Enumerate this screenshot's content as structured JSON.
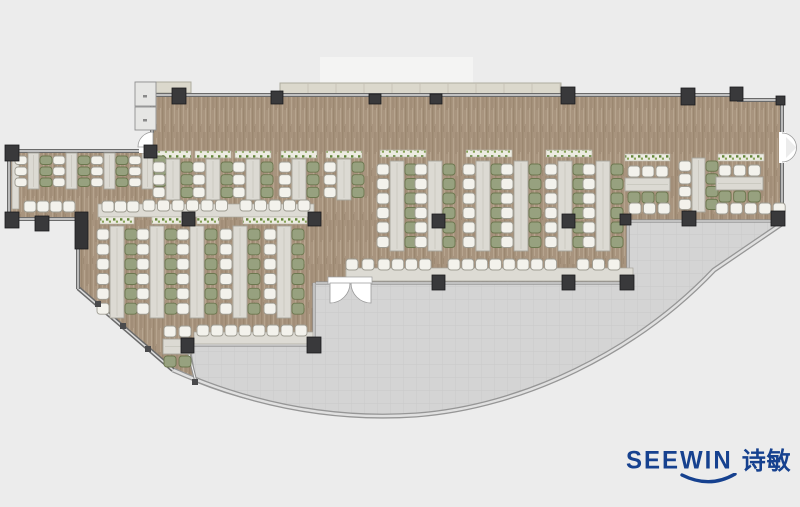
{
  "canvas": {
    "width": 800,
    "height": 507,
    "background": "#ececec"
  },
  "logo": {
    "brand": "SEEWIN",
    "brand_zh": "诗敏",
    "color": "#16418f"
  },
  "palette": {
    "floor_base": "#a8947e",
    "floor_grain_dark": "#9b8770",
    "floor_grain_light": "#b6a48e",
    "floor_grain_deep": "#8e7a64",
    "terrace": "#d4d4d4",
    "terrace_grid": "#c9c9c9",
    "wall_dark": "#6a6a6a",
    "wall_core": "#dcdcdc",
    "glass": "#8f8f8f",
    "glass_core": "#f3f3f3",
    "curve_outer": "#969696",
    "curve_core": "#e0e0e0",
    "column": "#39393b",
    "column_stroke": "#1b1b1d",
    "table": "#dcdad3",
    "table_stroke": "#a6a49b",
    "table_seam": "#c6c4bb",
    "chair_white": "#f3f2ec",
    "chair_white_stroke": "#9e9c92",
    "chair_green": "#97a17f",
    "chair_green_stroke": "#6c774f",
    "planter_bg": "#edece2",
    "planter_dot1": "#628539",
    "planter_dot2": "#85a355",
    "planter_stroke": "#b9b7aa",
    "ledge": "#dbd8cc",
    "ledge_line": "#c3c0b2",
    "ledge_stroke": "#aeab9e",
    "counter": "#dddbd4",
    "door_white": "#ffffff",
    "door_stroke": "#9a9a9a",
    "panel": "#e6e6e4",
    "panel_stroke": "#8f8f8f",
    "light_patch": "#f4f4f3"
  },
  "plan": {
    "floor_path": "M152 95 L737 95 L737 100 L782 100 L782 221 L628 221 L628 283 L316 283 L316 345 L190 345 L196 382 L173 370 L78 288 L78 219 L8 219 L8 151 L152 151 Z",
    "terrace_path": "M190 346 L314 346 L314 283 L628 283 L628 221 L782 221 L782 224 L714 270 C636 352 523 407 416 415 C325 421 245 402 196 382 Z",
    "curve_wall_path": "M173 370 C245 402 325 421 416 415 C523 407 636 352 714 270 L783 223",
    "diag_wall": [
      78,
      288,
      173,
      370
    ],
    "main_walls": [
      [
        150,
        95,
        737,
        95
      ],
      [
        737,
        95,
        737,
        100
      ],
      [
        737,
        100,
        782,
        100
      ],
      [
        782,
        100,
        782,
        133
      ],
      [
        782,
        162,
        782,
        221
      ],
      [
        152,
        95,
        152,
        133
      ],
      [
        8,
        151,
        155,
        151
      ],
      [
        9,
        151,
        9,
        220
      ],
      [
        9,
        219,
        78,
        219
      ],
      [
        78,
        248,
        78,
        289
      ]
    ],
    "glass_walls": [
      [
        190,
        345,
        316,
        345
      ],
      [
        314,
        283,
        314,
        346
      ],
      [
        316,
        283,
        329,
        283
      ],
      [
        371,
        283,
        628,
        283
      ],
      [
        628,
        221,
        628,
        284
      ],
      [
        627,
        221,
        783,
        221
      ],
      [
        187,
        346,
        196,
        382
      ]
    ],
    "ledge": [
      280,
      83,
      281,
      12
    ],
    "canopy": [
      137,
      82,
      54,
      11
    ],
    "light_patch": [
      320,
      57,
      153,
      27
    ],
    "counters": [
      [
        346,
        268,
        287,
        13
      ],
      [
        194,
        332,
        119,
        12
      ],
      [
        98,
        204,
        216,
        13
      ],
      [
        12,
        153,
        7,
        56
      ]
    ],
    "planters": [
      [
        155,
        151,
        36
      ],
      [
        195,
        151,
        36
      ],
      [
        235,
        151,
        36
      ],
      [
        281,
        151,
        36
      ],
      [
        326,
        151,
        36
      ],
      [
        380,
        150,
        46
      ],
      [
        466,
        150,
        46
      ],
      [
        546,
        150,
        46
      ],
      [
        625,
        154,
        45
      ],
      [
        718,
        154,
        46
      ],
      [
        100,
        217,
        34
      ],
      [
        152,
        217,
        30
      ],
      [
        197,
        217,
        22
      ],
      [
        243,
        217,
        64
      ]
    ],
    "desk_units_vertical": [
      {
        "x": [
          28,
          66,
          104,
          142
        ],
        "y1": 153,
        "y2": 189,
        "tw": 11,
        "chairs": 3,
        "left": "w",
        "right": "g"
      },
      {
        "x": [
          166,
          206,
          246,
          292,
          337
        ],
        "y1": 159,
        "y2": 200,
        "tw": 14,
        "chairs": 3,
        "left": "w",
        "right": "g"
      },
      {
        "x": [
          390,
          428,
          476,
          514,
          558,
          596
        ],
        "y1": 161,
        "y2": 251,
        "tw": 14,
        "chairs": 6,
        "left": "w",
        "right": "g"
      },
      {
        "x": [
          110,
          150,
          190,
          233,
          277
        ],
        "y1": 226,
        "y2": 318,
        "tw": 14,
        "chairs": 6,
        "left": "w",
        "right": "g"
      },
      {
        "x": [
          692
        ],
        "y1": 158,
        "y2": 212,
        "tw": 13,
        "chairs": 4,
        "left": "w",
        "right": "g"
      }
    ],
    "desk_units_horizontal": [
      {
        "x1": 625,
        "x2": 670,
        "ty": 178,
        "th": 13,
        "chairs": 3,
        "top": "w",
        "bottom": "g"
      },
      {
        "x1": 716,
        "x2": 763,
        "ty": 177,
        "th": 13,
        "chairs": 3,
        "top": "w",
        "bottom": "g"
      }
    ],
    "chair_rows": [
      {
        "x": 24,
        "y": 201,
        "n": 4,
        "pitch": 13,
        "c": "w"
      },
      {
        "x": 102,
        "y": 201,
        "n": 3,
        "pitch": 12.5,
        "c": "w"
      },
      {
        "x": 143,
        "y": 200,
        "n": 6,
        "pitch": 14.5,
        "c": "w"
      },
      {
        "x": 240,
        "y": 200,
        "n": 5,
        "pitch": 14.5,
        "c": "w"
      },
      {
        "x": 346,
        "y": 259,
        "n": 2,
        "pitch": 16,
        "c": "w"
      },
      {
        "x": 378,
        "y": 259,
        "n": 4,
        "pitch": 13.7,
        "c": "w"
      },
      {
        "x": 448,
        "y": 259,
        "n": 8,
        "pitch": 13.8,
        "c": "w"
      },
      {
        "x": 577,
        "y": 259,
        "n": 3,
        "pitch": 15.5,
        "c": "w"
      },
      {
        "x": 197,
        "y": 325,
        "n": 8,
        "pitch": 14,
        "c": "w"
      },
      {
        "x": 629,
        "y": 203,
        "n": 3,
        "pitch": 14.5,
        "c": "w"
      },
      {
        "x": 716,
        "y": 203,
        "n": 5,
        "pitch": 14.3,
        "c": "w"
      }
    ],
    "small_table": {
      "table": [
        163,
        339,
        29,
        15
      ],
      "chairs": [
        [
          164,
          326,
          "w"
        ],
        [
          179,
          326,
          "w"
        ],
        [
          164,
          356,
          "g"
        ],
        [
          179,
          356,
          "g"
        ]
      ]
    },
    "columns": [
      [
        172,
        88,
        14,
        16
      ],
      [
        271,
        91,
        12,
        13
      ],
      [
        369,
        94,
        12,
        10
      ],
      [
        430,
        94,
        12,
        10
      ],
      [
        561,
        87,
        14,
        17
      ],
      [
        681,
        88,
        14,
        17
      ],
      [
        730,
        87,
        13,
        14
      ],
      [
        776,
        96,
        9,
        9
      ],
      [
        144,
        145,
        13,
        13
      ],
      [
        5,
        145,
        14,
        16
      ],
      [
        5,
        212,
        14,
        16
      ],
      [
        35,
        216,
        14,
        15
      ],
      [
        182,
        212,
        13,
        14
      ],
      [
        308,
        212,
        13,
        14
      ],
      [
        432,
        214,
        13,
        14
      ],
      [
        562,
        214,
        13,
        14
      ],
      [
        432,
        275,
        13,
        15
      ],
      [
        562,
        275,
        13,
        15
      ],
      [
        620,
        275,
        14,
        15
      ],
      [
        620,
        214,
        11,
        11
      ],
      [
        682,
        211,
        14,
        15
      ],
      [
        771,
        211,
        14,
        15
      ],
      [
        181,
        338,
        13,
        15
      ],
      [
        307,
        337,
        14,
        16
      ]
    ],
    "shaft": [
      75,
      212,
      13,
      37
    ],
    "posts": [
      [
        95,
        301
      ],
      [
        120,
        323
      ],
      [
        145,
        346
      ],
      [
        192,
        379
      ]
    ],
    "doors": {
      "left_wedge": "M153 132 L153 147 L138 147 A15 15 0 0 1 153 132 Z",
      "left_gap": [
        139,
        146,
        13,
        7
      ],
      "right_gap": [
        779,
        132,
        7,
        31
      ],
      "right_arcs": [
        "M782 133 A14.5 14.5 0 0 1 796.5 147.5",
        "M782 162 A14.5 14.5 0 0 0 796.5 147.5"
      ],
      "terrace_lintel": [
        328,
        277,
        44,
        7
      ],
      "terrace_wedges": [
        "M330 283 L350 283 A20 20 0 0 1 330 303 Z",
        "M371 283 L351 283 A20 20 0 0 0 371 303 Z"
      ]
    },
    "entry_panel": {
      "rects": [
        [
          135,
          82,
          21,
          24
        ],
        [
          135,
          107,
          21,
          23
        ]
      ],
      "marks": [
        [
          143,
          95
        ],
        [
          143,
          119
        ]
      ]
    }
  }
}
